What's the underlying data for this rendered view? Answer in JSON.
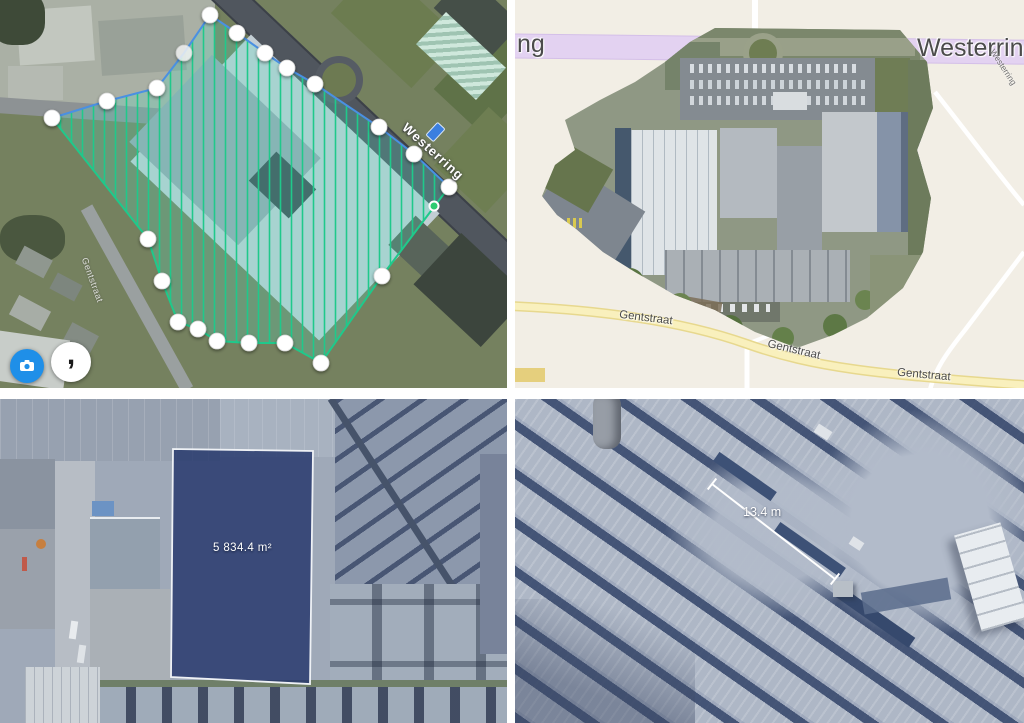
{
  "panels": {
    "flight_plan": {
      "road_label": "Westerring",
      "street_label": "Gentstraat",
      "buttons": {
        "layers": {
          "icon": "camera-icon"
        },
        "rotate": {
          "icon": "rotate-icon",
          "glyph": ","
        }
      },
      "colors": {
        "hatch_green": "#1fc98b",
        "outline_blue": "#4a90e2",
        "marker_white": "#ffffff",
        "button_blue": "#1f8fe8"
      }
    },
    "orthomosaic": {
      "highway_label_partial": "ng",
      "highway_label": "Westerring",
      "side_road_label": "Westerring",
      "street_labels": [
        "Gentstraat",
        "Gentstraat",
        "Gentstraat"
      ],
      "colors": {
        "highway_purple": "#e3d2f1",
        "street_yellow": "#f9f0bd",
        "basemap": "#f2eee5"
      }
    },
    "area_measurement": {
      "area_label": "5 834.4 m²",
      "colors": {
        "selection_fill": "#2a3f6e",
        "selection_outline": "#eef1f5"
      }
    },
    "distance_measurement": {
      "distance_label": "13.4 m",
      "colors": {
        "line": "#ffffff"
      }
    }
  }
}
